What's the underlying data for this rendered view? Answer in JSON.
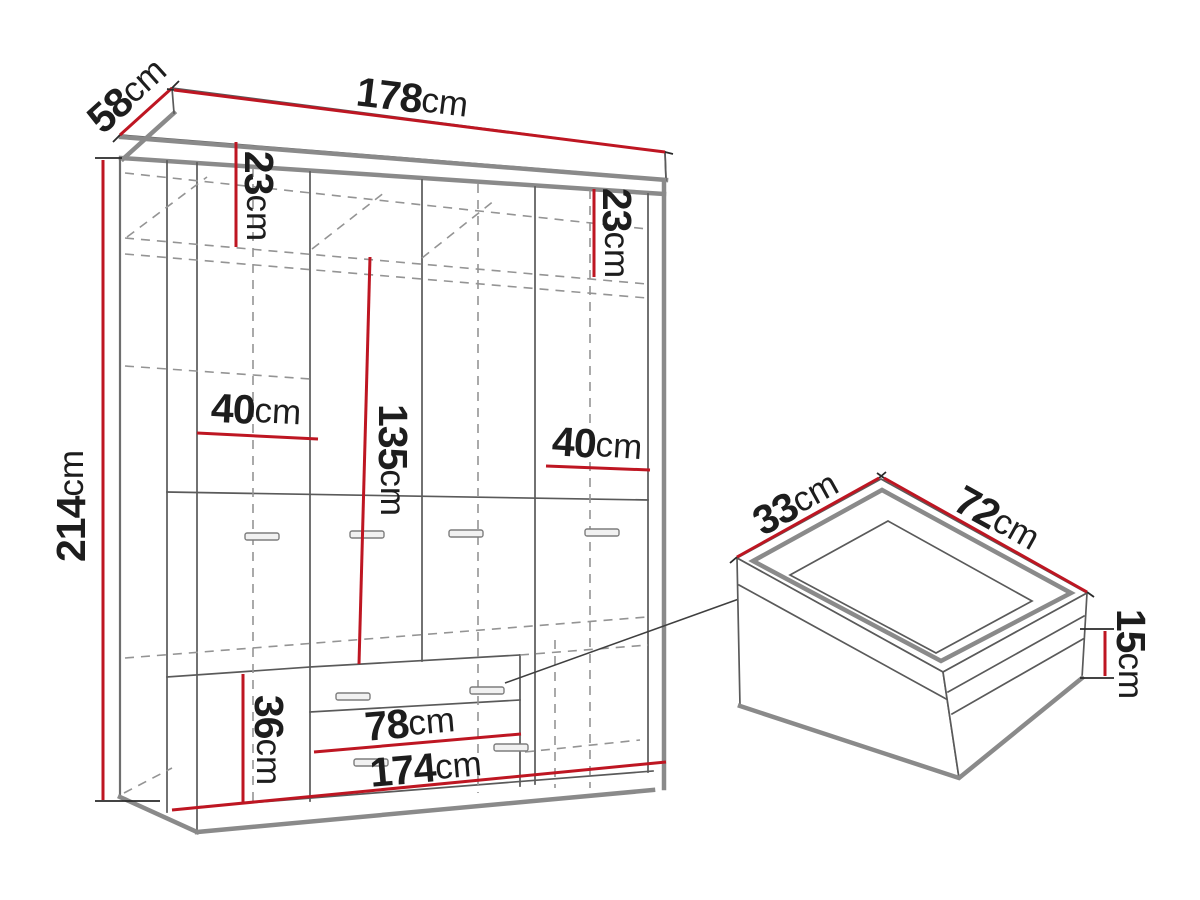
{
  "diagram": {
    "type": "furniture-dimension-drawing",
    "subject": "four-door wardrobe with drawer detail",
    "unit": "cm",
    "colors": {
      "dimension_line": "#be1622",
      "outline": "#5a5a5a",
      "thick_edge": "#8a8a8a",
      "hidden_line": "#949494",
      "label_text": "#1d1d1d",
      "background": "#ffffff"
    },
    "wardrobe": {
      "width": {
        "value": "178",
        "unit": "cm"
      },
      "depth": {
        "value": "58",
        "unit": "cm"
      },
      "height": {
        "value": "214",
        "unit": "cm"
      },
      "top_shelf_height_left": {
        "value": "23",
        "unit": "cm"
      },
      "top_shelf_height_right": {
        "value": "23",
        "unit": "cm"
      },
      "section_width_left": {
        "value": "40",
        "unit": "cm"
      },
      "hanging_space_height": {
        "value": "135",
        "unit": "cm"
      },
      "section_width_right": {
        "value": "40",
        "unit": "cm"
      },
      "bottom_section_height": {
        "value": "36",
        "unit": "cm"
      },
      "drawer_opening_width": {
        "value": "78",
        "unit": "cm"
      },
      "interior_width": {
        "value": "174",
        "unit": "cm"
      }
    },
    "drawer_detail": {
      "depth": {
        "value": "33",
        "unit": "cm"
      },
      "width": {
        "value": "72",
        "unit": "cm"
      },
      "height": {
        "value": "15",
        "unit": "cm"
      }
    }
  }
}
